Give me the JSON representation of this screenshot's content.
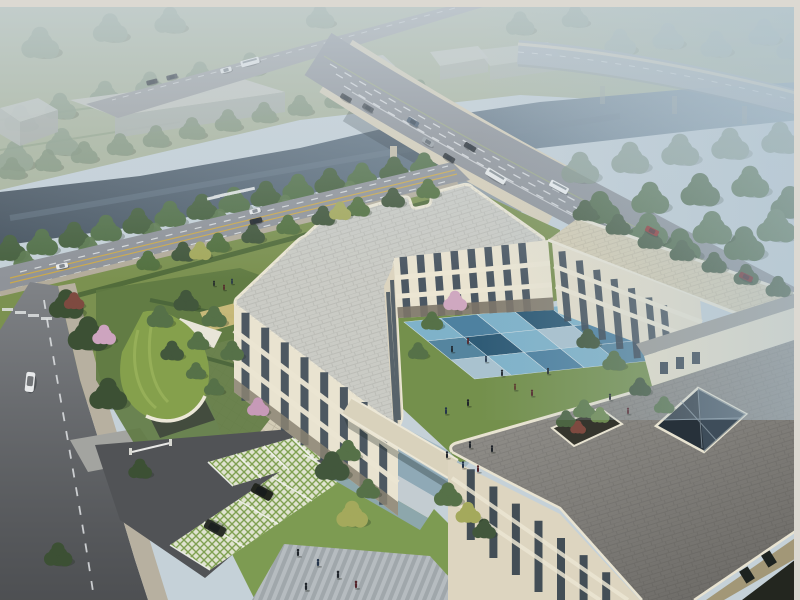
{
  "scene": {
    "type": "architectural-aerial-rendering",
    "description": "Hazy aerial rendering of a three-storey cream courtyard building complex with a blue checkerboard plaza, green-roof gate pavilion, grass-paver parking, riverside trees, a road bridge over a canal and an elevated highway",
    "time_of_day": "hazy daylight"
  },
  "palette": {
    "frame": "#dcd9d2",
    "sky": "#c5d1d8",
    "field": "#a9b49b",
    "water_near": "#4a5763",
    "water_far": "#8ba0ae",
    "road_secondary": "#9b9ea0",
    "road_main": "#8d9197",
    "bridge_edge": "#d8cfb8",
    "viaduct": "#a7b0b6",
    "road_north": "#8f9399",
    "road_west": "#808387",
    "sidewalk": "#b7b0a0",
    "lawn": "#7b9150",
    "lawn_bright": "#7d9b52",
    "courtyard_lawn": "#74904c",
    "hedge": "#4e6838",
    "paving_checker": "#d3ccb6",
    "green_roof": "#85a04c",
    "roof_grey": "#cacbc5",
    "roof_beige": "#d7ceb3",
    "roof_front": "#8a8884",
    "parapet_cream": "#e7e0ca",
    "facade_cream": "#e9e3d0",
    "facade_shade": "#ddd5c0",
    "window_glass": "#3c4a58",
    "window_frame": "#ece6d3",
    "plaza_blue": "#8fa9b6",
    "plaza_light": "#c3ccd1",
    "parking_base": "#dfe3cf",
    "stall_green": "#7fa051",
    "tree_dark": "#42573c",
    "tree_mid": "#567148",
    "tree_light": "#6d8757",
    "tree_hazy": "#8a9c87",
    "tree_yellow": "#a4a95c",
    "tree_pink": "#cda4bf",
    "tree_red": "#7e4a40",
    "courtyard": {
      "c1": "#7fb2c9",
      "c2": "#4e81a0",
      "c3": "#2f5b76",
      "c4": "#a9c2cf",
      "c5": "#55859f"
    },
    "vehicles": {
      "bus": "#e9ebeb",
      "truck": "#f0f1f2",
      "red": "#8e2b28",
      "dark_red": "#6e2424",
      "van": "#e8eaeb",
      "suv": "#23261f",
      "dark_car": "#2c3136"
    }
  },
  "objects": {
    "buildings": [
      "west-wing",
      "north-wing",
      "east-wing",
      "front-building",
      "connecting-walkway",
      "gate-pavilion",
      "distant-warehouses"
    ],
    "infrastructure": [
      "river-canal",
      "road-bridge",
      "elevated-viaduct",
      "secondary-road",
      "north-road",
      "west-road",
      "crosswalks"
    ],
    "landscape": [
      "riverside-tree-rows",
      "campus-lawns",
      "flowering-trees",
      "curved-green-roof",
      "blue-checkerboard-courtyard",
      "grass-paver-parking",
      "roof-planter",
      "roof-lightwell"
    ],
    "vehicle_count": {
      "bridge_cars": 6,
      "bus": 1,
      "truck": 1,
      "red_cars": 2,
      "parked_suvs": 2,
      "white_van": 1,
      "street_cars": 3
    },
    "people_groups": [
      "courtyard-walkers",
      "entry-plaza-group",
      "south-plaza-group",
      "north-lawn-pair"
    ]
  }
}
